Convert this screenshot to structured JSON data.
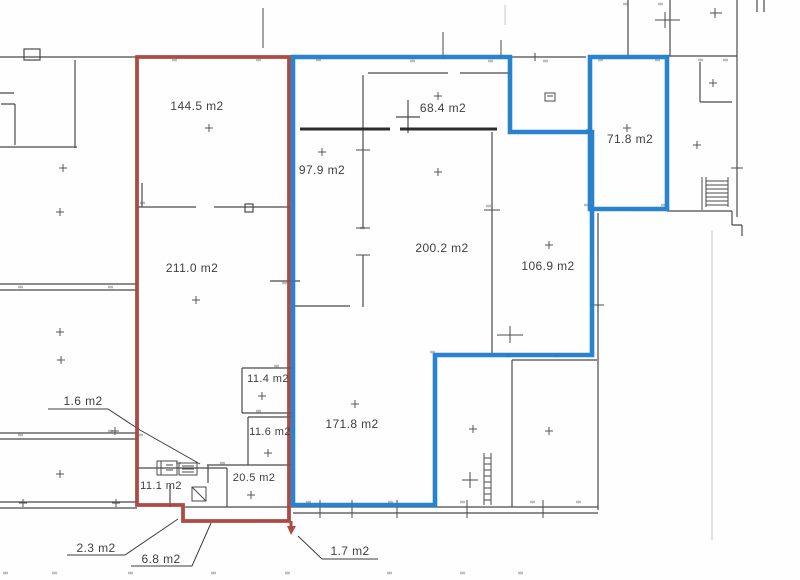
{
  "plan": {
    "unit_suffix": "m2",
    "marked_outlines": [
      "red",
      "blue"
    ]
  },
  "colors": {
    "red_outline": "#a8423a",
    "blue_outline": "#1e7ccc",
    "wall_line": "#4a4a4a",
    "thick_wall_line": "#2c2c2c",
    "label_text": "#3f3f3f"
  },
  "rooms": [
    {
      "area": "144.5 m2"
    },
    {
      "area": "97.9 m2"
    },
    {
      "area": "68.4 m2"
    },
    {
      "area": "200.2 m2"
    },
    {
      "area": "106.9 m2"
    },
    {
      "area": "71.8 m2"
    },
    {
      "area": "211.0 m2"
    },
    {
      "area": "171.8 m2"
    },
    {
      "area": "11.4 m2"
    },
    {
      "area": "11.6 m2"
    },
    {
      "area": "20.5 m2"
    },
    {
      "area": "11.1 m2"
    }
  ],
  "callouts": [
    {
      "area": "1.6 m2"
    },
    {
      "area": "2.3 m2"
    },
    {
      "area": "6.8 m2"
    },
    {
      "area": "1.7 m2"
    }
  ]
}
